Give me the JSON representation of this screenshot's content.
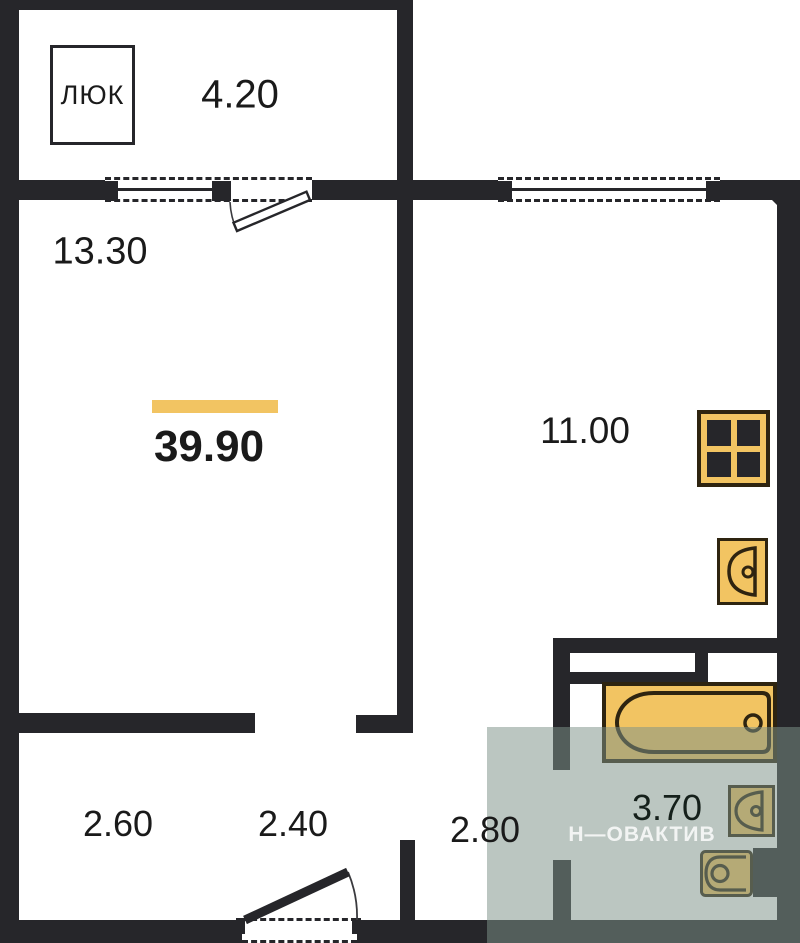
{
  "plan": {
    "type": "apartment-floor-plan",
    "total_area": "39.90",
    "rooms": {
      "balcony": "4.20",
      "living": "13.30",
      "kitchen": "11.00",
      "bathroom": "3.70",
      "hall_left": "2.60",
      "hall_mid": "2.40",
      "hall_right": "2.80"
    },
    "hatch_label": "ЛЮК",
    "watermark": "Н—ОВАКТИВ",
    "fixtures": [
      "stove-icon",
      "kitchen-sink-icon",
      "bathtub-icon",
      "washbasin-icon",
      "toilet-icon"
    ]
  },
  "colors": {
    "wall": "#26262a",
    "ink": "#1a1a1a",
    "fixture_fill": "#f2c462",
    "fixture_border": "#2e2410",
    "accent_bar": "#f2c462",
    "bathroom_overlay": "#7d928a",
    "watermark_text": "#ffffff"
  }
}
